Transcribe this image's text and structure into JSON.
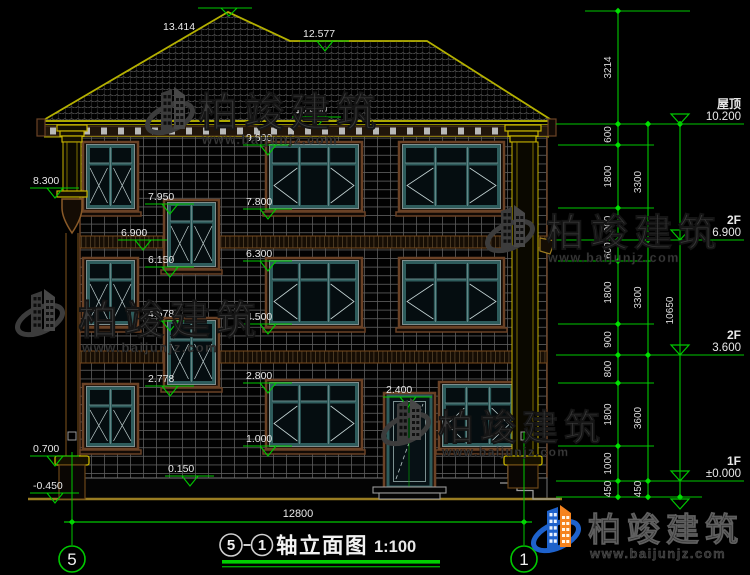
{
  "page": {
    "background": "#000000"
  },
  "colors": {
    "annotation_green": "#00c800",
    "roof_yellow": "#b4b000",
    "trim_brown": "#6b4226",
    "frame_teal": "#2e5c5c",
    "text_white": "#e8e8e8",
    "watermark_gray": "#3a3a3a",
    "logo_blue": "#1e62cc",
    "logo_orange": "#f5831f"
  },
  "title_block": {
    "axis_start": "5",
    "axis_end": "1",
    "separator": "-",
    "title": "轴立面图",
    "scale": "1:100"
  },
  "bottom_dimension": {
    "label": "12800"
  },
  "axis_bubbles": [
    {
      "label": "5"
    },
    {
      "label": "1"
    }
  ],
  "floor_markers": [
    {
      "name": "屋顶",
      "value": "10.200"
    },
    {
      "name": "2F",
      "value": "6.900"
    },
    {
      "name": "2F",
      "value": "3.600"
    },
    {
      "name": "1F",
      "value": "±0.000"
    }
  ],
  "elevation_markers": [
    "13.414",
    "12.577",
    "10.400",
    "9.600",
    "8.300",
    "7.950",
    "7.800",
    "6.900",
    "6.300",
    "6.150",
    "4.578",
    "4.500",
    "2.800",
    "2.778",
    "2.400",
    "1.000",
    "0.700",
    "0.150",
    "-0.450"
  ],
  "dimensions": {
    "inner": [
      "3214",
      "600",
      "1800",
      "900",
      "600",
      "1800",
      "900",
      "800",
      "1800",
      "1000",
      "450"
    ],
    "middle": [
      "3300",
      "3300",
      "3600",
      "450"
    ],
    "outer": [
      "10650"
    ]
  },
  "watermark": {
    "company": "柏竣建筑",
    "website": "www.baijunjz.com"
  }
}
